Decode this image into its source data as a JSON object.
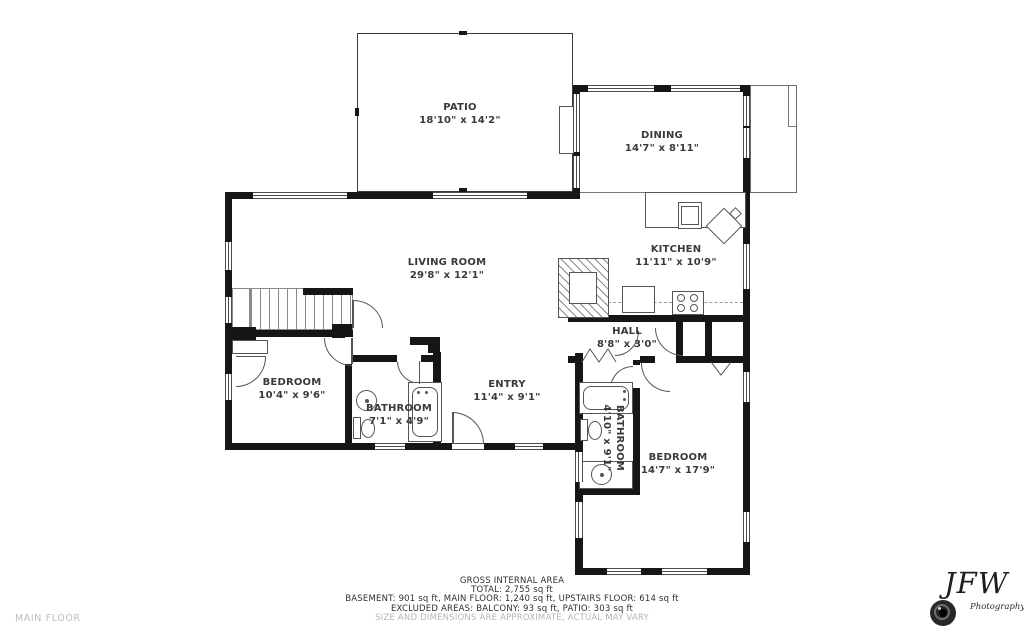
{
  "rooms": {
    "patio": {
      "name": "PATIO",
      "dims": "18'10\" x 14'2\""
    },
    "dining": {
      "name": "DINING",
      "dims": "14'7\" x 8'11\""
    },
    "living": {
      "name": "LIVING ROOM",
      "dims": "29'8\" x 12'1\""
    },
    "kitchen": {
      "name": "KITCHEN",
      "dims": "11'11\" x 10'9\""
    },
    "hall": {
      "name": "HALL",
      "dims": "8'8\" x 3'0\""
    },
    "bedroom_left": {
      "name": "BEDROOM",
      "dims": "10'4\" x 9'6\""
    },
    "bathroom_left": {
      "name": "BATHROOM",
      "dims": "7'1\" x 4'9\""
    },
    "entry": {
      "name": "ENTRY",
      "dims": "11'4\" x 9'1\""
    },
    "bathroom_right": {
      "name": "BATHROOM",
      "dims": "4'10\" x 9'1\""
    },
    "bedroom_right": {
      "name": "BEDROOM",
      "dims": "14'7\" x 17'9\""
    }
  },
  "footer": {
    "floor_label": "MAIN FLOOR",
    "gross_title": "GROSS INTERNAL AREA",
    "total": "TOTAL: 2,755 sq ft",
    "breakdown": "BASEMENT: 901 sq ft, MAIN FLOOR: 1,240 sq ft, UPSTAIRS FLOOR: 614 sq ft",
    "excluded": "EXCLUDED AREAS: BALCONY: 93 sq ft, PATIO: 303 sq ft",
    "disclaimer": "SIZE AND DIMENSIONS ARE APPROXIMATE, ACTUAL MAY VARY"
  },
  "logo": {
    "initials": "JFW",
    "subtitle": "Photography"
  },
  "colors": {
    "wall": "#161616",
    "label_text": "#3a3a3a",
    "muted_text": "#b5b5b5"
  }
}
